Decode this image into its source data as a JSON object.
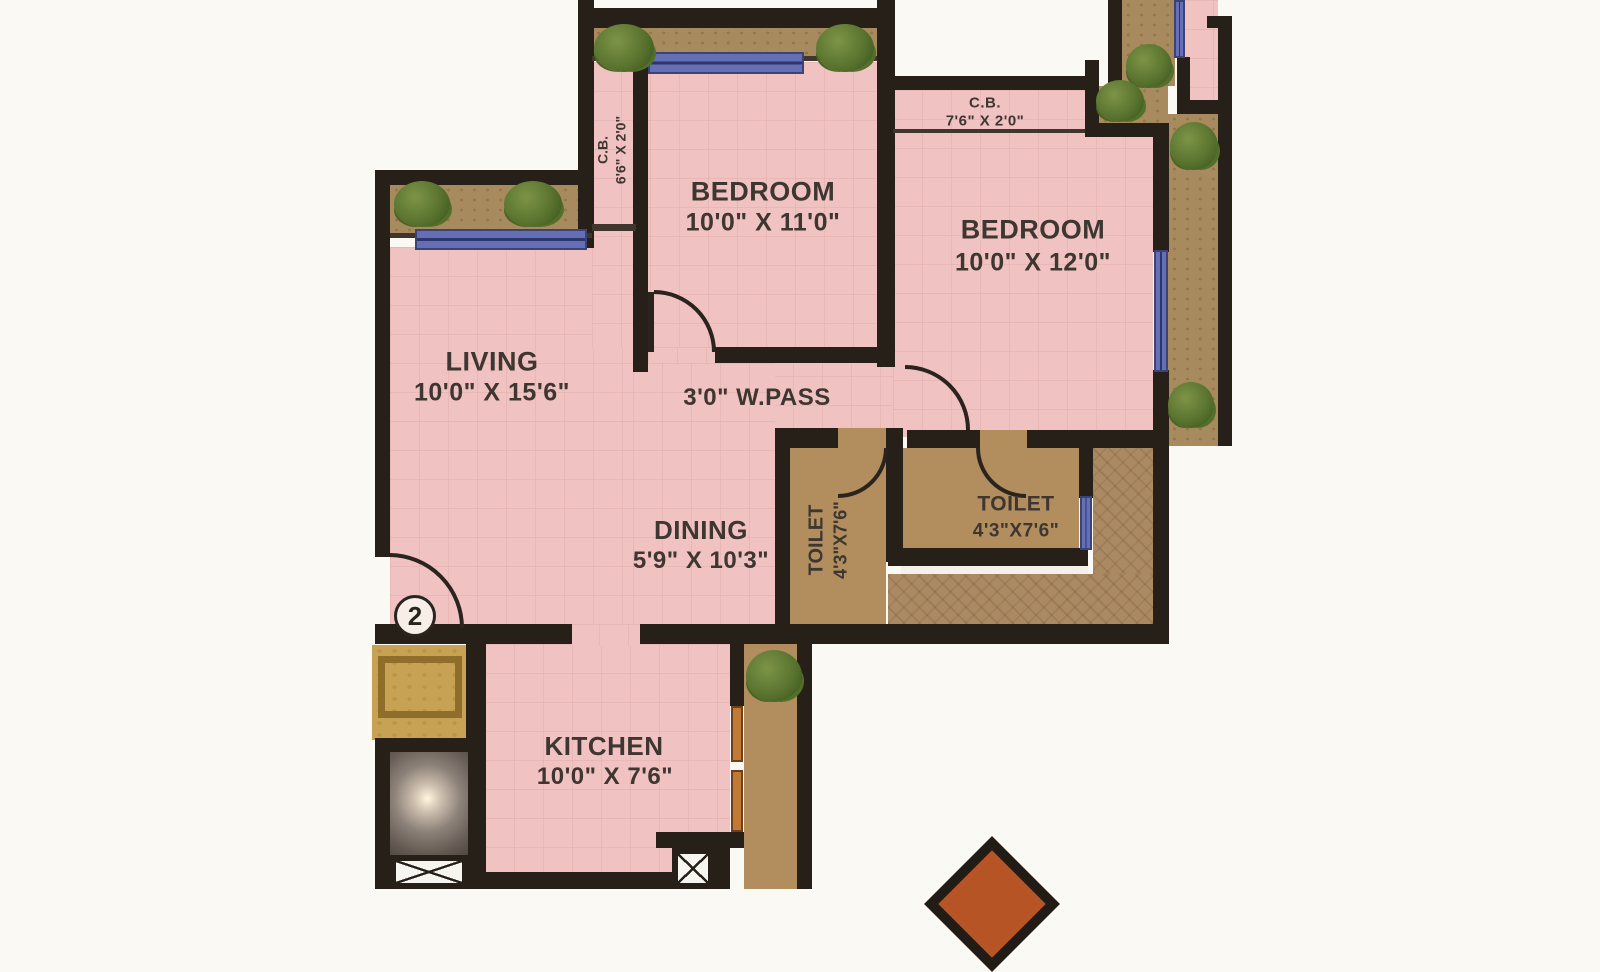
{
  "plan": {
    "unit_badge": "2",
    "rooms": {
      "bedroom1": {
        "name": "BEDROOM",
        "dims": "10'0\" X 11'0\""
      },
      "bedroom2": {
        "name": "BEDROOM",
        "dims": "10'0\" X 12'0\""
      },
      "living": {
        "name": "LIVING",
        "dims": "10'0\" X 15'6\""
      },
      "wpass": {
        "name": "3'0\" W.PASS"
      },
      "dining": {
        "name": "DINING",
        "dims": "5'9\" X 10'3\""
      },
      "toilet1": {
        "name": "TOILET",
        "dims": "4'3\"X7'6\""
      },
      "toilet2": {
        "name": "TOILET",
        "dims": "4'3\"X7'6\""
      },
      "kitchen": {
        "name": "KITCHEN",
        "dims": "10'0\" X 7'6\""
      },
      "cb1": {
        "name": "C.B.",
        "dims": "6'6\" X 2'0\""
      },
      "cb2": {
        "name": "C.B.",
        "dims": "7'6\" X 2'0\""
      }
    },
    "colors": {
      "wall": "#262019",
      "room_pink": "#f0c2c1",
      "floor_tan": "#b28e5f",
      "lobby_gold": "#c7a254",
      "window_blue": "#6570b4",
      "shrub_green": "#5d7a33",
      "compass_orange": "#b65426",
      "label_text": "#3e3630"
    }
  }
}
